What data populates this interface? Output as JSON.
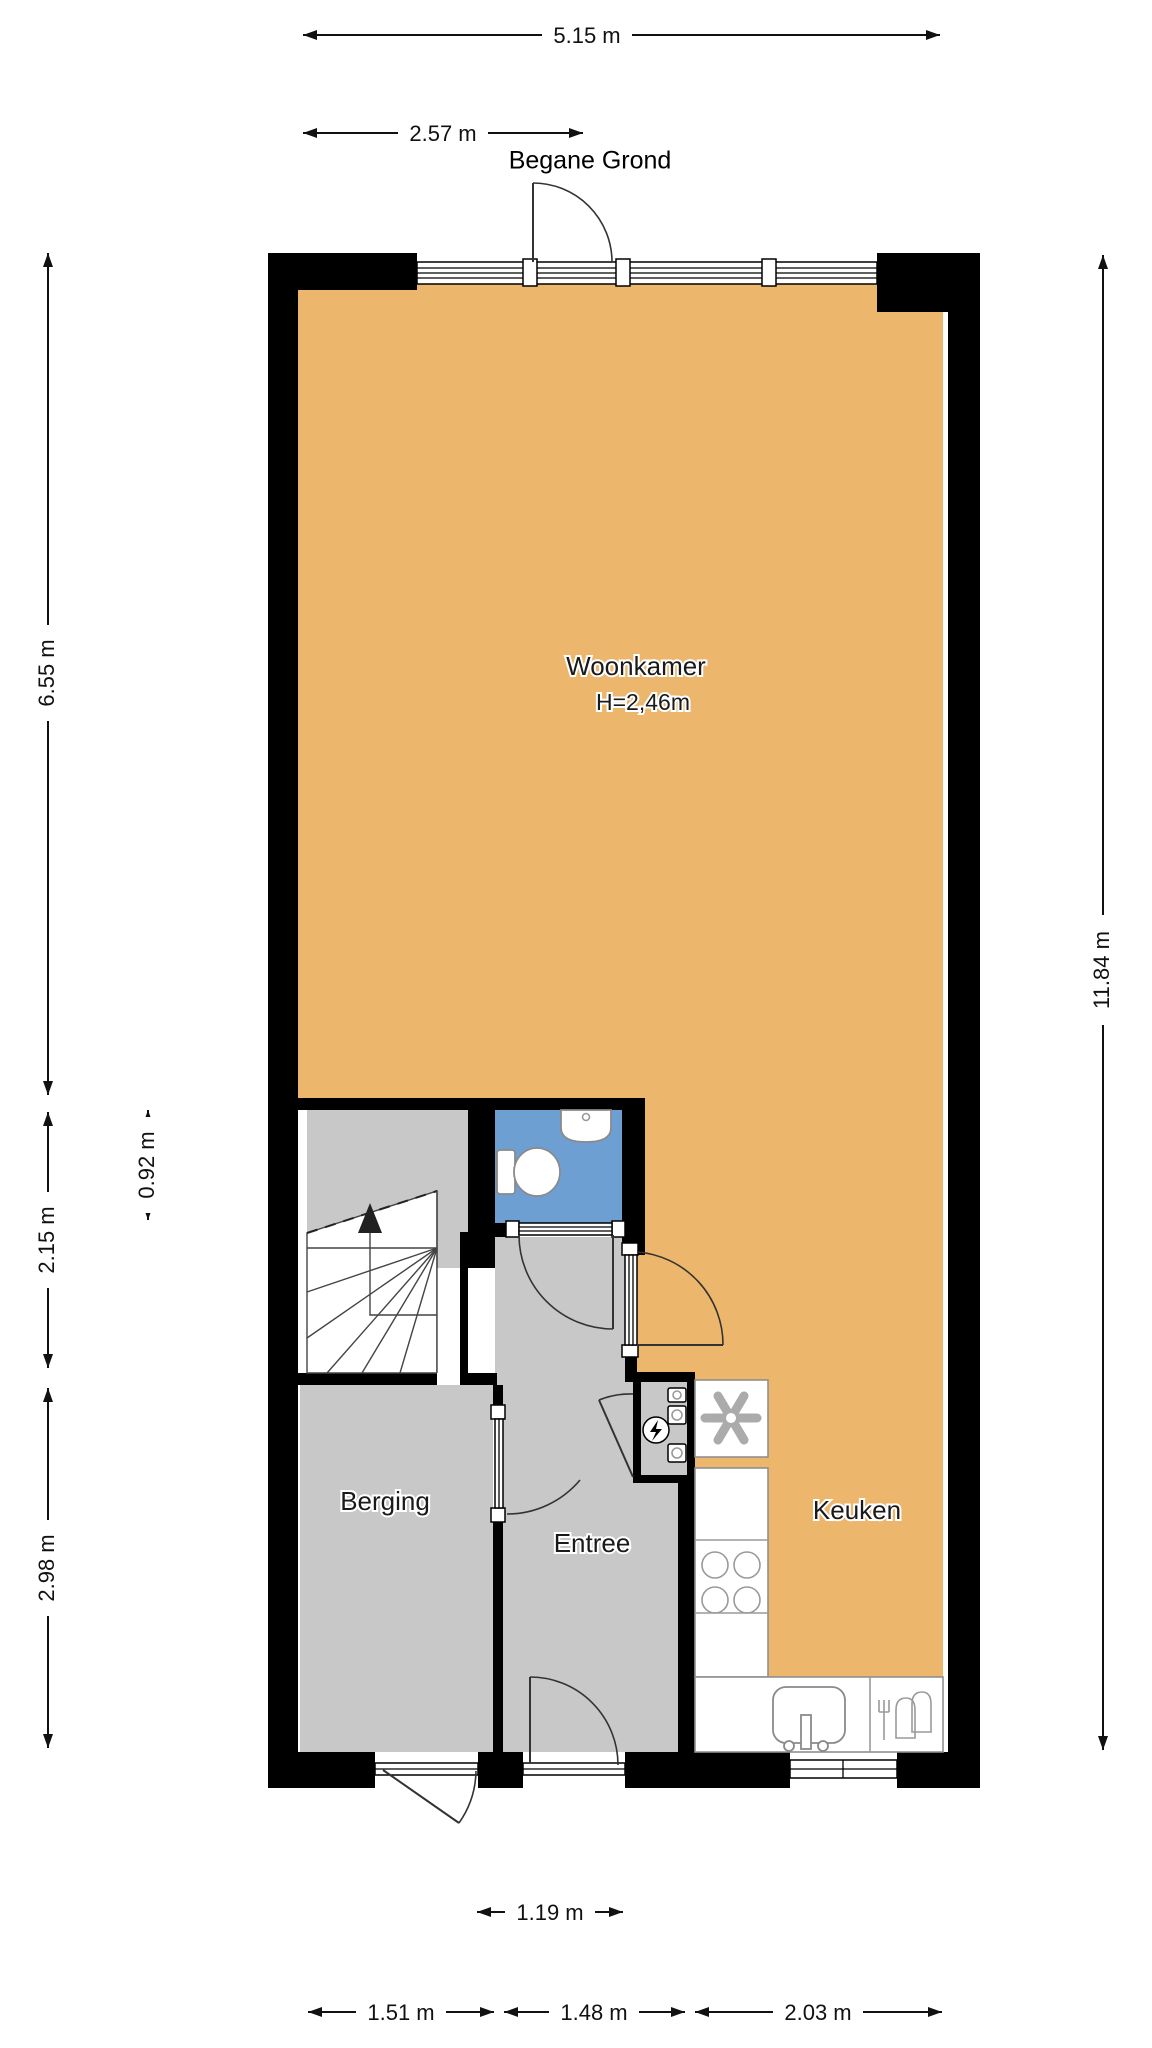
{
  "title": "Begane Grond",
  "rooms": {
    "woonkamer": {
      "label": "Woonkamer",
      "ceiling_height": "H=2,46m"
    },
    "keuken": {
      "label": "Keuken"
    },
    "berging": {
      "label": "Berging"
    },
    "entree": {
      "label": "Entree"
    }
  },
  "dimensions": {
    "top_total": "5.15 m",
    "top_left": "2.57 m",
    "left_upper": "6.55 m",
    "left_wc": "0.92 m",
    "left_stairs": "2.15 m",
    "left_lower": "2.98 m",
    "right_total": "11.84 m",
    "bottom_door": "1.19 m",
    "bottom_berging": "1.51 m",
    "bottom_entree": "1.48 m",
    "bottom_keuken": "2.03 m"
  },
  "colors": {
    "floor_living": "#ECB66C",
    "floor_wet_room": "#6E9FD3",
    "floor_circulation": "#C8C8C8",
    "walls": "#000000",
    "background": "#FFFFFF"
  },
  "fixtures": [
    "toilet",
    "wash-basin",
    "stair-up-arrow",
    "mechanical-ventilation-fan",
    "electric-meter",
    "utility-meters",
    "cooktop-4-burners",
    "kitchen-sink",
    "dishwasher",
    "entry-doors",
    "windows"
  ]
}
